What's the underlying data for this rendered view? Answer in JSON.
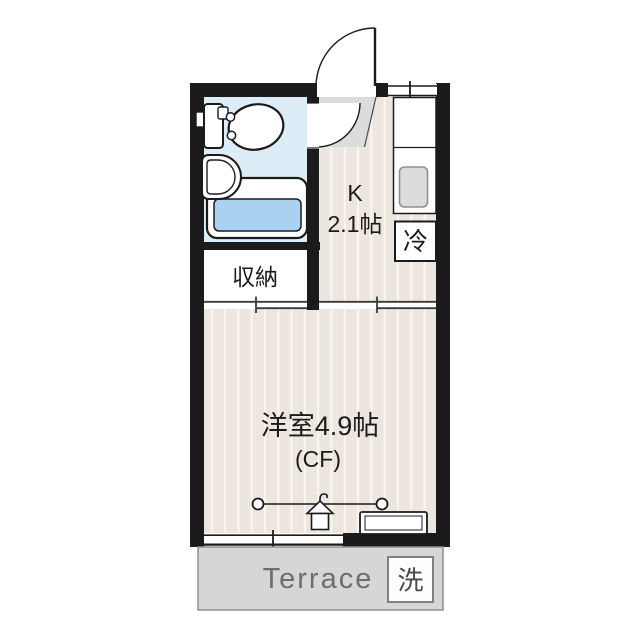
{
  "floorplan": {
    "kitchen": {
      "label": "K",
      "area": "2.1帖"
    },
    "western_room": {
      "label": "洋室4.9帖",
      "flooring": "(CF)"
    },
    "storage": {
      "label": "収納"
    },
    "refrigerator": {
      "label": "冷"
    },
    "washer": {
      "label": "洗"
    },
    "terrace": {
      "label": "Terrace"
    },
    "colors": {
      "wall": "#1b1b1b",
      "floor_base": "#ece6de",
      "floor_stripe": "#f9f6f2",
      "bathroom": "#dcedf8",
      "bathtub_water": "#a9d2f0",
      "genkan": "#dcdcdc",
      "stove": "#dcdcdc",
      "terrace_bg": "#d6d6d6",
      "terrace_text": "#6e6e6e",
      "washer_text": "#4a4a4a"
    }
  }
}
